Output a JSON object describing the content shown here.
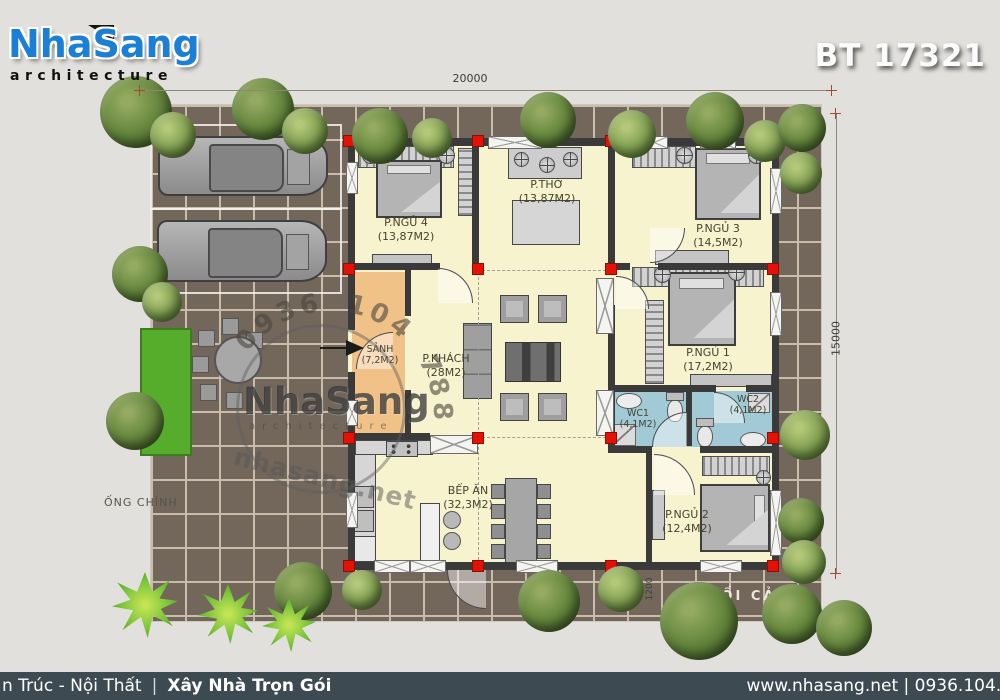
{
  "header": {
    "logo_title": "NhaSang",
    "logo_subtitle": "architecture",
    "plan_code": "BT 17321"
  },
  "dimensions": {
    "top_width": "20000",
    "right_height": "15000",
    "porch_depth": "1200"
  },
  "site_labels": {
    "main_pipe": "ỐNG CHÍNH",
    "perspective": "PHỐI CẢNH"
  },
  "watermark": {
    "phone_arc": "0936 104 788",
    "brand": "NhaSang",
    "brand_sub": "architecture",
    "url": "nhasang.net"
  },
  "rooms": [
    {
      "name": "P.NGỦ 4",
      "area": "(13,87M2)"
    },
    {
      "name": "P.THỜ",
      "area": "(13,87M2)"
    },
    {
      "name": "P.NGỦ 3",
      "area": "(14,5M2)"
    },
    {
      "name": "SẢNH",
      "area": "(7,2M2)"
    },
    {
      "name": "P.KHÁCH",
      "area": "(28M2)"
    },
    {
      "name": "P.NGỦ 1",
      "area": "(17,2M2)"
    },
    {
      "name": "WC1",
      "area": "(4,1M2)"
    },
    {
      "name": "WC2",
      "area": "(4,1M2)"
    },
    {
      "name": "BẾP ĂN",
      "area": "(32,3M2)"
    },
    {
      "name": "P.NGỦ 2",
      "area": "(12,4M2)"
    }
  ],
  "footer": {
    "left_prefix": "n Trúc - Nội Thất",
    "separator": "|",
    "left_bold": "Xây Nhà Trọn Gói",
    "right": "www.nhasang.net | 0936.104.7"
  },
  "colors": {
    "brand_blue": "#1c7fd6",
    "footer_bg": "#3d4a52",
    "room_floor": "#f8f3cf",
    "hall_floor": "#f0c287",
    "wc_floor": "#a2c9d6",
    "column_red": "#e41107"
  }
}
